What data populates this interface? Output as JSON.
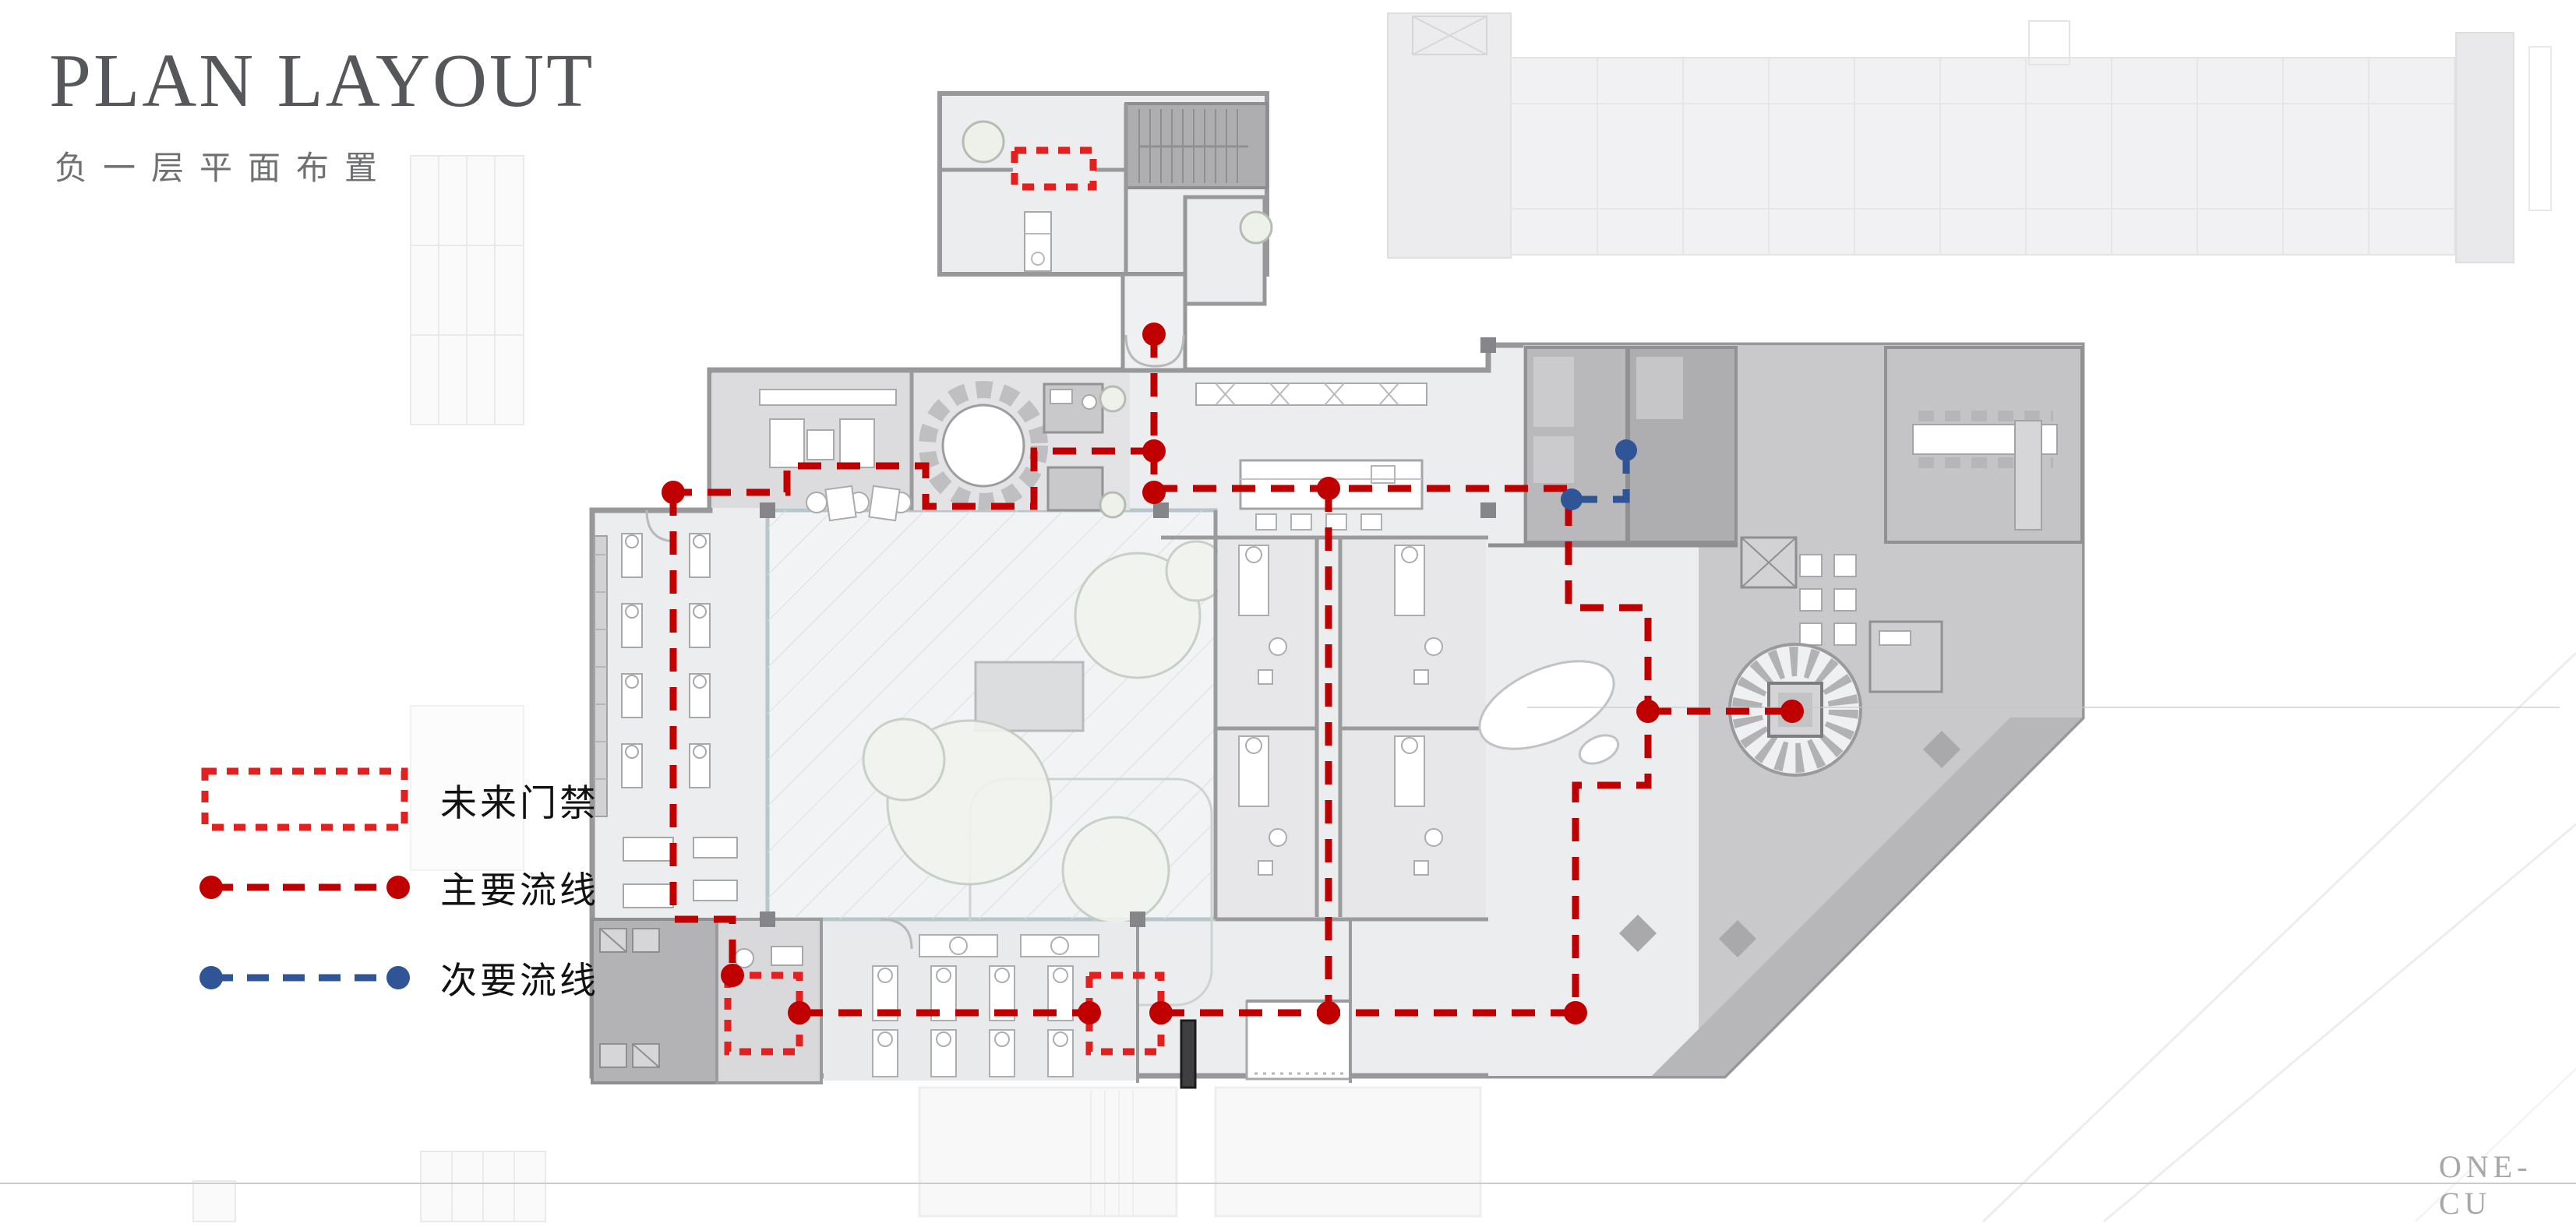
{
  "slide": {
    "title": "PLAN LAYOUT",
    "subtitle": "负一层平面布置",
    "watermark": "ONE-CU"
  },
  "legend": {
    "items": [
      {
        "id": "future-access-control",
        "label": "未来门禁",
        "color": "#e32020",
        "style": "dotted-rect"
      },
      {
        "id": "primary-circulation",
        "label": "主要流线",
        "color": "#c00000",
        "style": "dashed-line-dots"
      },
      {
        "id": "secondary-circulation",
        "label": "次要流线",
        "color": "#2f5597",
        "style": "dashed-line-dots"
      }
    ]
  }
}
